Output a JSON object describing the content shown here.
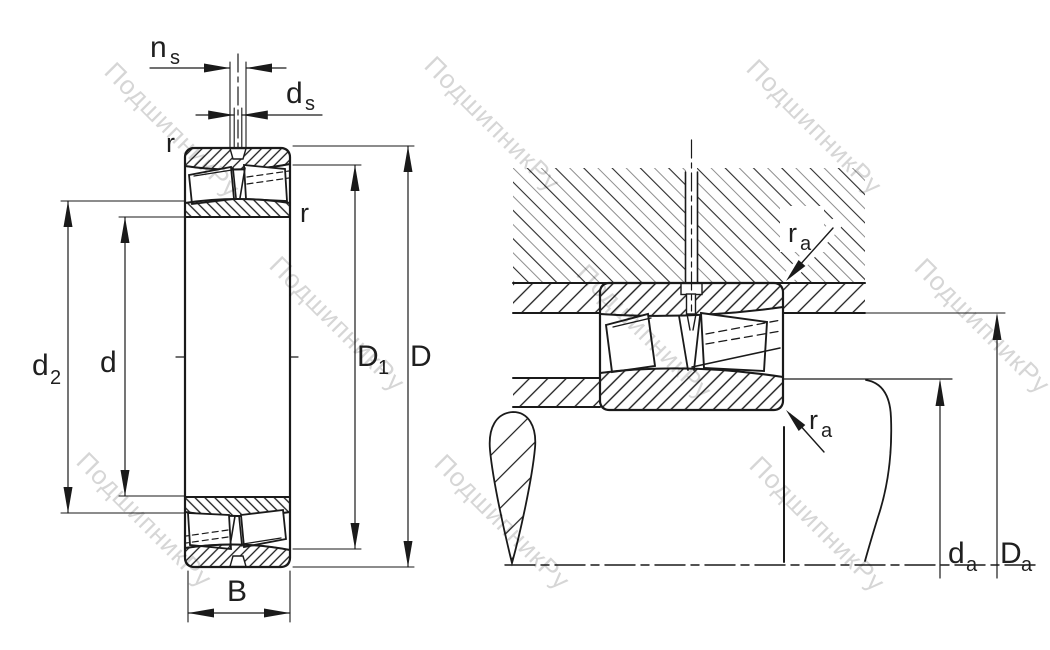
{
  "watermark": {
    "text": "ПодшипникРу",
    "color": "#d6d6d6"
  },
  "colors": {
    "line": "#1a1a1a",
    "label": "#1f1f1f",
    "watermark": "#d6d6d6",
    "hatch_secondary": "#8f8f8f"
  },
  "left": {
    "ns_main": "n",
    "ns_sub": "s",
    "ds_main": "d",
    "ds_sub": "s",
    "r_top": "r",
    "r_side": "r",
    "d2_main": "d",
    "d2_sub": "2",
    "d": "d",
    "D1_main": "D",
    "D1_sub": "1",
    "D": "D",
    "B": "B"
  },
  "right": {
    "ra_top_main": "r",
    "ra_top_sub": "a",
    "ra_bottom_main": "r",
    "ra_bottom_sub": "a",
    "da_main": "d",
    "da_sub": "a",
    "Da_main": "D",
    "Da_sub": "a"
  }
}
